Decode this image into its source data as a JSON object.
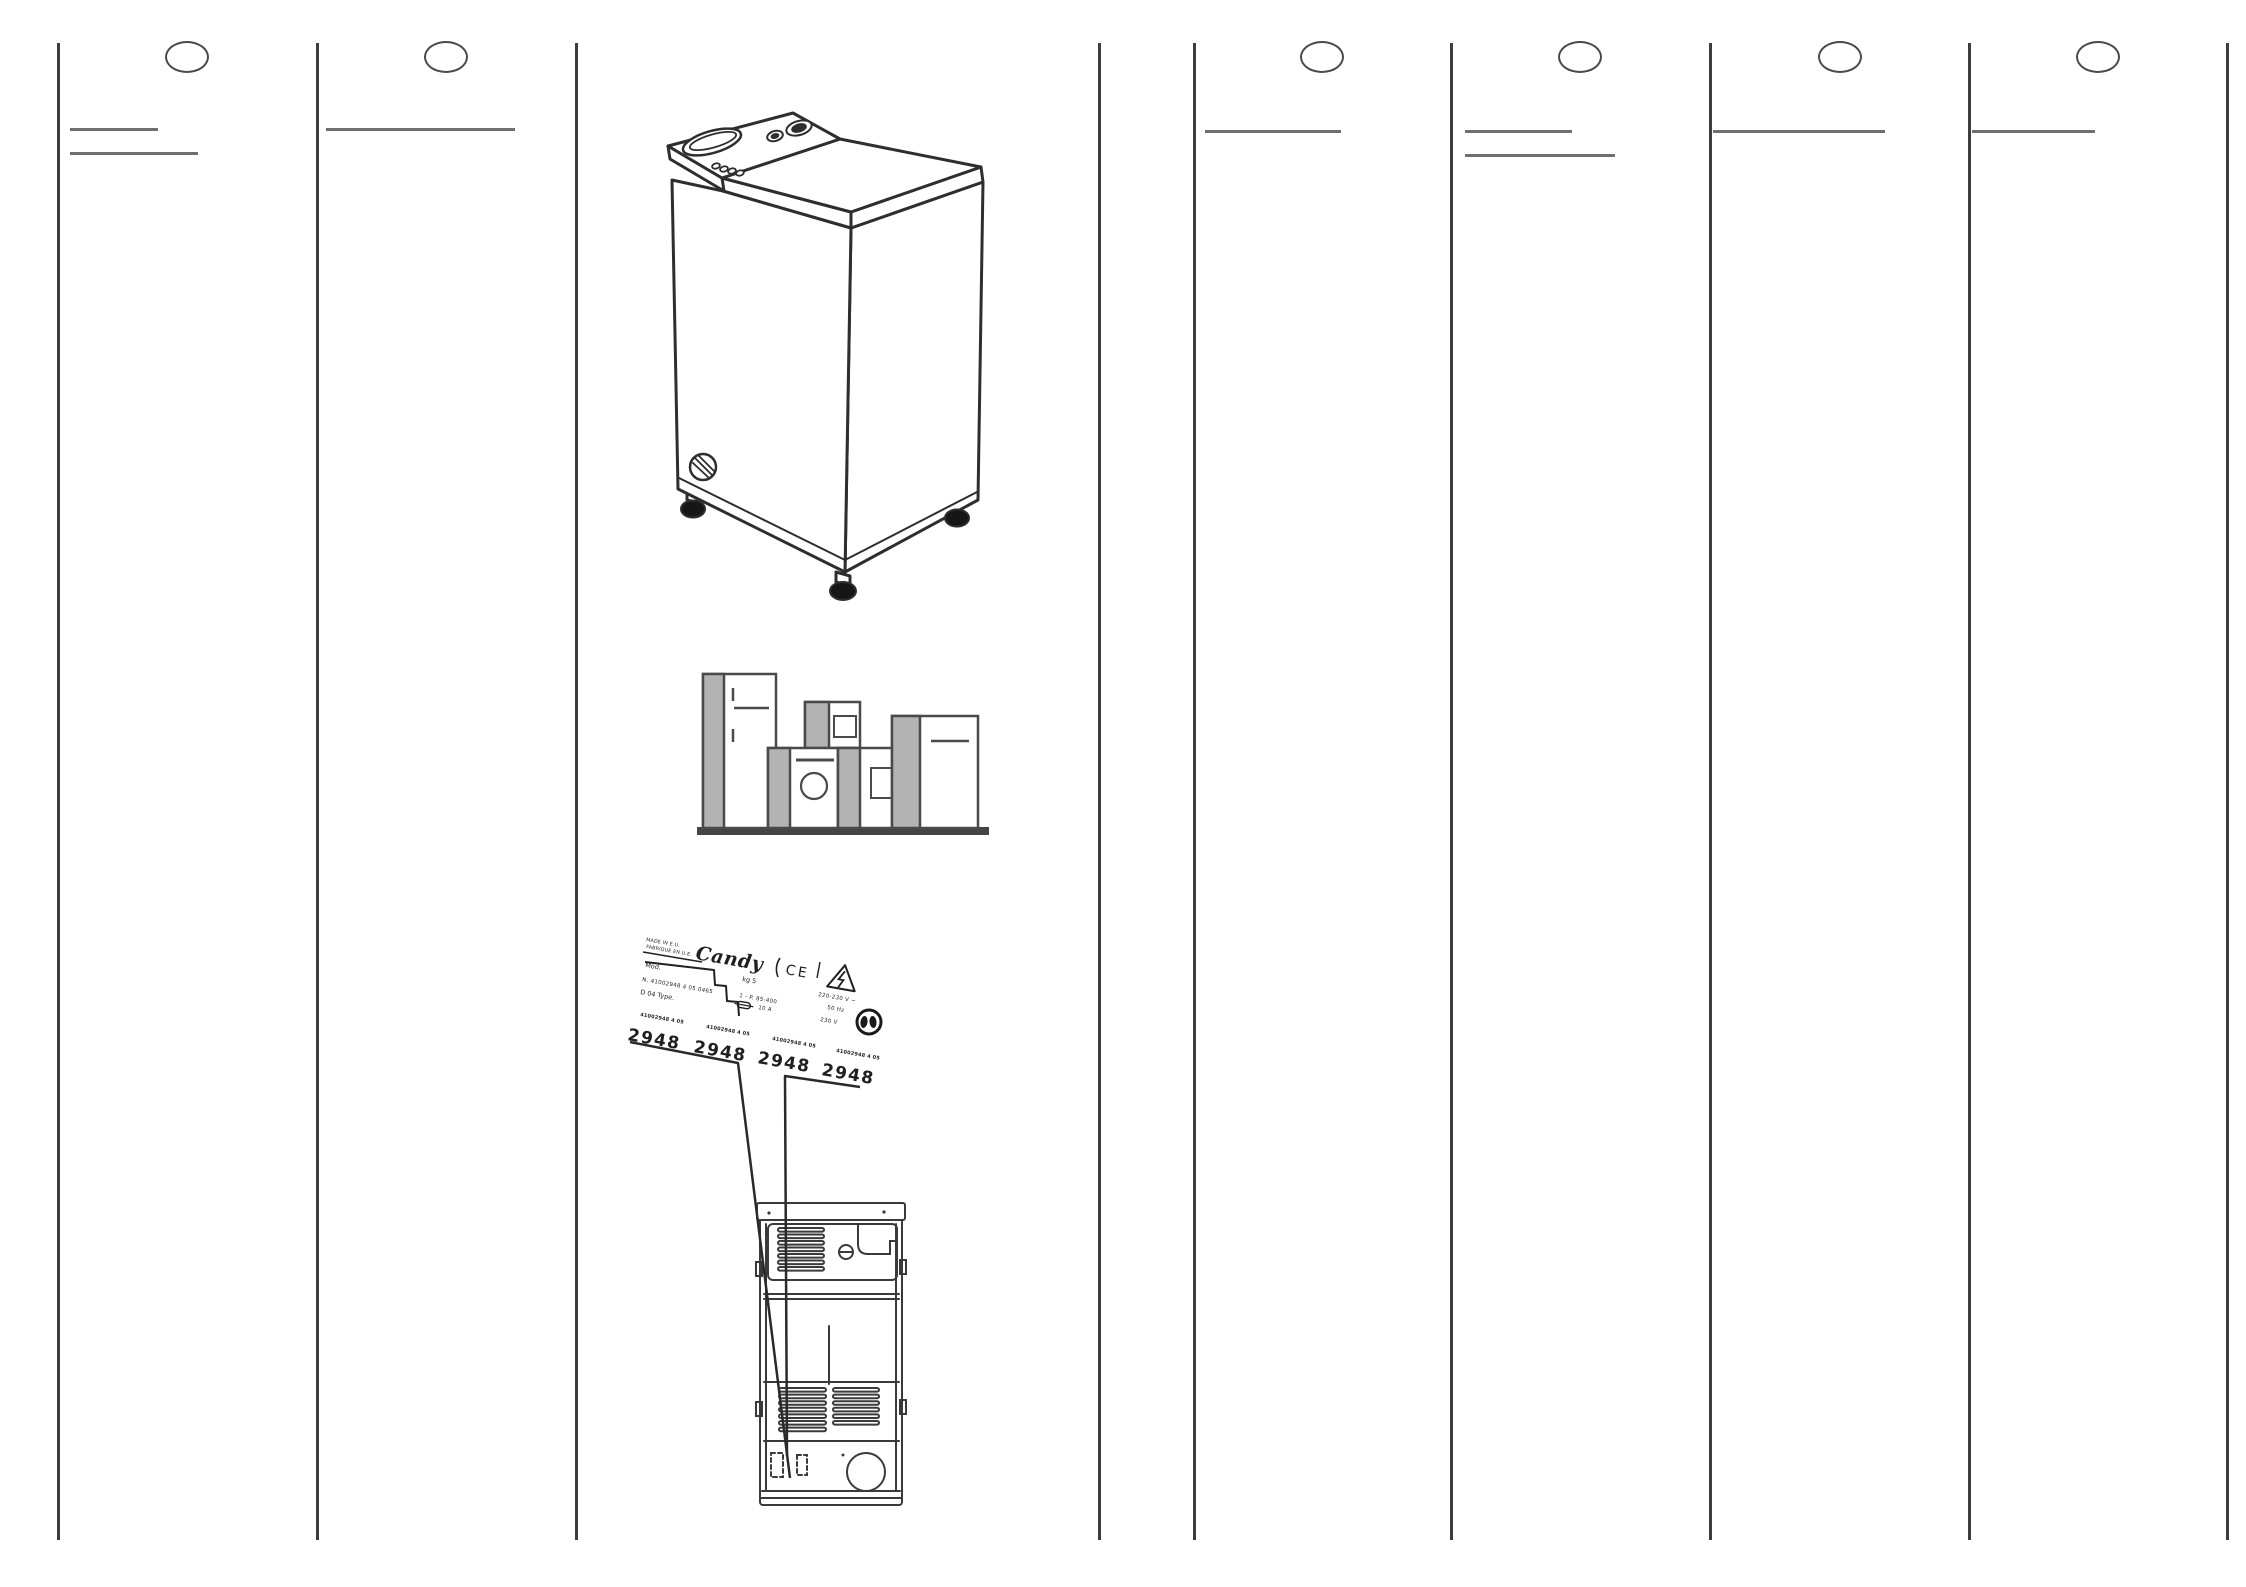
{
  "colors": {
    "paper": "#ffffff",
    "ink": "#2e2e2e",
    "separator": "#3d3d3d",
    "underline": "#6e6e6e",
    "gray_fill": "#b3b3b3",
    "baseline_dark": "#444444"
  },
  "layout": {
    "separators": [
      58,
      317,
      576,
      1099,
      1194,
      1451,
      1710,
      1969,
      2227
    ],
    "sep_top": 43,
    "sep_bottom": 1540,
    "circle_cy": 57,
    "circle_w": 44,
    "circle_h": 32,
    "circles": [
      {
        "cx": 187
      },
      {
        "cx": 446
      },
      {
        "cx": 1322
      },
      {
        "cx": 1580
      },
      {
        "cx": 1840
      },
      {
        "cx": 2098
      }
    ],
    "underlines": [
      {
        "x1": 70,
        "x2": 158,
        "y": 128
      },
      {
        "x1": 70,
        "x2": 198,
        "y": 152
      },
      {
        "x1": 326,
        "x2": 515,
        "y": 128
      },
      {
        "x1": 1205,
        "x2": 1341,
        "y": 130
      },
      {
        "x1": 1465,
        "x2": 1572,
        "y": 130
      },
      {
        "x1": 1465,
        "x2": 1615,
        "y": 154
      },
      {
        "x1": 1713,
        "x2": 1885,
        "y": 130
      },
      {
        "x1": 1972,
        "x2": 2095,
        "y": 130
      }
    ]
  },
  "figures": {
    "washer": "top-loading-washing-machine-isometric",
    "appliances": "row-of-household-appliances",
    "plate": "rating-plate-label",
    "backview": "washing-machine-rear-view"
  },
  "rating_plate": {
    "made_in_line1": "MADE IN E.U.",
    "made_in_line2": "FABRIQUE EN U.E.",
    "brand": "Candy",
    "ce_mark": "CE",
    "mod_label": "Mod.",
    "serial_line": "N.  41002948 4 05 0465",
    "type_line": "D    04    Type.",
    "kg_line": "kg 5",
    "power_line": "1 - P. 85-400",
    "amp_line": "10 A",
    "volt_line": "220-230 V ~",
    "hz_line": "50 Hz",
    "volt2_line": "230 V",
    "codes": [
      {
        "small": "41002948 4 05",
        "big": "2948"
      },
      {
        "small": "41002948 4 05",
        "big": "2948"
      },
      {
        "small": "41002948 4 05",
        "big": "2948"
      },
      {
        "small": "41002948 4 05",
        "big": "2948"
      }
    ]
  }
}
